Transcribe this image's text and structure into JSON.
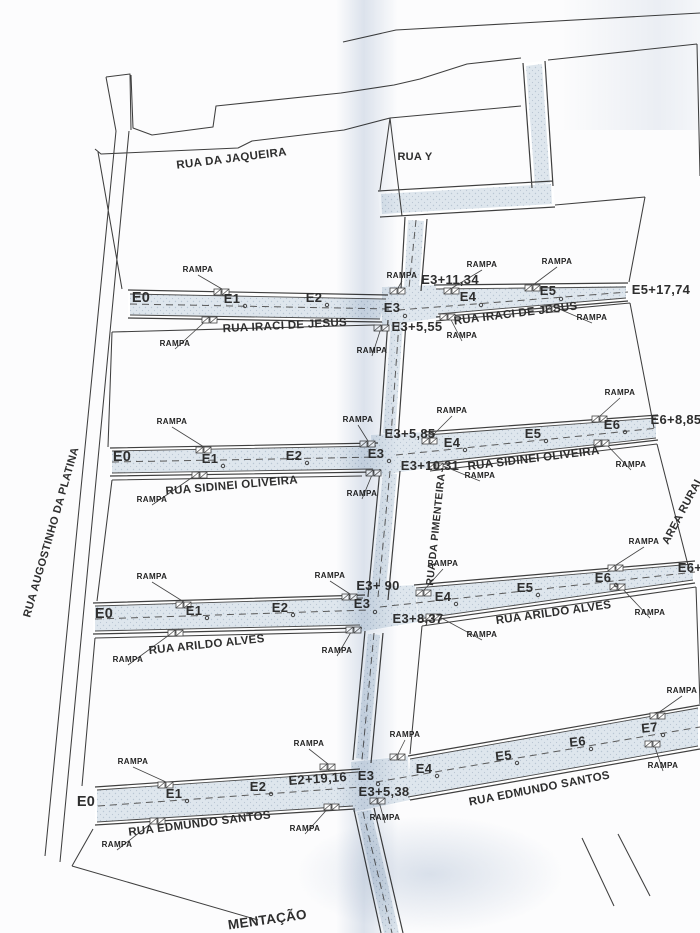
{
  "document": {
    "kind": "scanned street pavement plan"
  },
  "colors": {
    "ink": "#3f3f3f",
    "text": "#2e2e2e",
    "road_fill": "#dee6ed",
    "stipple_dots": "#b9c6d3",
    "paper": "#fcfcfd",
    "fold_shadow": "#c4d0e0"
  },
  "rampa_label": "RAMPA",
  "street_names": [
    "RUA DA JAQUEIRA",
    "RUA Y",
    "RUA IRACI DE JESUS",
    "RUA SIDINEI OLIVEIRA",
    "RUA DA PIMENTEIRA",
    "RUA ARILDO ALVES",
    "RUA EDMUNDO SANTOS",
    "RUA AUGOSTINHO DA PLATINA",
    "AREA RURAL"
  ],
  "labels": [
    {
      "id": "rua-da-jaqueira",
      "text": "RUA DA JAQUEIRA",
      "x": 232,
      "y": 162,
      "rot": -7,
      "size": 11.5
    },
    {
      "id": "rua-y",
      "text": "RUA Y",
      "x": 415,
      "y": 160,
      "rot": 0,
      "size": 11
    },
    {
      "id": "rua-iraci-de-jesus-left",
      "text": "RUA IRACI DE JESUS",
      "x": 285,
      "y": 329,
      "rot": -3,
      "size": 11.5
    },
    {
      "id": "rua-iraci-de-jesus-right",
      "text": "RUA IRACI DE JESUS",
      "x": 516,
      "y": 317,
      "rot": -7,
      "size": 11.5
    },
    {
      "id": "rua-sidinei-oliveira-left",
      "text": "RUA SIDINEI OLIVEIRA",
      "x": 232,
      "y": 489,
      "rot": -5,
      "size": 11.5
    },
    {
      "id": "rua-sidinei-oliveira-right",
      "text": "RUA SIDINEI OLIVEIRA",
      "x": 534,
      "y": 462,
      "rot": -7,
      "size": 11.5
    },
    {
      "id": "rua-arildo-alves-left",
      "text": "RUA ARILDO ALVES",
      "x": 207,
      "y": 648,
      "rot": -6,
      "size": 11.5
    },
    {
      "id": "rua-arildo-alves-right",
      "text": "RUA ARILDO ALVES",
      "x": 554,
      "y": 616,
      "rot": -8,
      "size": 11.5
    },
    {
      "id": "rua-edmundo-santos-left",
      "text": "RUA EDMUNDO SANTOS",
      "x": 200,
      "y": 827,
      "rot": -7,
      "size": 11.5
    },
    {
      "id": "rua-edmundo-santos-right",
      "text": "RUA EDMUNDO SANTOS",
      "x": 540,
      "y": 792,
      "rot": -11,
      "size": 11.5
    },
    {
      "id": "rua-augostinho-da-platina",
      "text": "RUA AUGOSTINHO DA PLATINA",
      "x": 30,
      "y": 618,
      "rot": -74,
      "size": 11,
      "anchor": "start"
    },
    {
      "id": "rua-da-pimenteira",
      "text": "RUA DA PIMENTEIRA",
      "x": 433,
      "y": 586,
      "rot": -84,
      "size": 10.5,
      "anchor": "start"
    },
    {
      "id": "area-rural",
      "text": "AREA RURAL",
      "x": 668,
      "y": 545,
      "rot": -62,
      "size": 11,
      "anchor": "start"
    },
    {
      "id": "bottom-partial-text",
      "text": "MENTAÇÃO",
      "x": 268,
      "y": 924,
      "rot": -8,
      "size": 13.5
    },
    {
      "id": "r1-e0",
      "text": "E0",
      "x": 141,
      "y": 302,
      "rot": 0,
      "size": 14.5
    },
    {
      "id": "r1-e1",
      "text": "E1",
      "x": 232,
      "y": 303,
      "rot": 0,
      "size": 13,
      "dot": [
        13,
        3
      ]
    },
    {
      "id": "r1-e2",
      "text": "E2",
      "x": 314,
      "y": 302,
      "rot": 0,
      "size": 13,
      "dot": [
        13,
        3
      ]
    },
    {
      "id": "r1-e3",
      "text": "E3",
      "x": 392,
      "y": 312,
      "rot": 0,
      "size": 13,
      "dot": [
        13,
        4
      ]
    },
    {
      "id": "r1-e3p11-34",
      "text": "E3+11,34",
      "x": 450,
      "y": 284,
      "rot": 0,
      "size": 13
    },
    {
      "id": "r1-e3p5-55",
      "text": "E3+5,55",
      "x": 417,
      "y": 331,
      "rot": 0,
      "size": 13
    },
    {
      "id": "r1-e4",
      "text": "E4",
      "x": 468,
      "y": 301,
      "rot": 0,
      "size": 13,
      "dot": [
        13,
        4
      ]
    },
    {
      "id": "r1-e5",
      "text": "E5",
      "x": 548,
      "y": 295,
      "rot": 0,
      "size": 13,
      "dot": [
        13,
        4
      ]
    },
    {
      "id": "r1-e5p17-74",
      "text": "E5+17,74",
      "x": 661,
      "y": 294,
      "rot": 0,
      "size": 13
    },
    {
      "id": "r2-e0",
      "text": "E0",
      "x": 122,
      "y": 461,
      "rot": 0,
      "size": 14.5
    },
    {
      "id": "r2-e1",
      "text": "E1",
      "x": 210,
      "y": 463,
      "rot": 0,
      "size": 13,
      "dot": [
        13,
        3
      ]
    },
    {
      "id": "r2-e2",
      "text": "E2",
      "x": 294,
      "y": 460,
      "rot": 0,
      "size": 13,
      "dot": [
        13,
        3
      ]
    },
    {
      "id": "r2-e3",
      "text": "E3",
      "x": 376,
      "y": 458,
      "rot": 0,
      "size": 13,
      "dot": [
        13,
        3
      ]
    },
    {
      "id": "r2-e3p5-85",
      "text": "E3+5,85",
      "x": 410,
      "y": 438,
      "rot": 0,
      "size": 13
    },
    {
      "id": "r2-e3p10-31",
      "text": "E3+10,31",
      "x": 430,
      "y": 470,
      "rot": 0,
      "size": 13
    },
    {
      "id": "r2-e4",
      "text": "E4",
      "x": 452,
      "y": 447,
      "rot": 0,
      "size": 13,
      "dot": [
        13,
        3
      ]
    },
    {
      "id": "r2-e5",
      "text": "E5",
      "x": 533,
      "y": 438,
      "rot": 0,
      "size": 13,
      "dot": [
        13,
        3
      ]
    },
    {
      "id": "r2-e6",
      "text": "E6",
      "x": 612,
      "y": 429,
      "rot": 0,
      "size": 13,
      "dot": [
        13,
        3
      ]
    },
    {
      "id": "r2-e6p8-85",
      "text": "E6+8,85",
      "x": 676,
      "y": 424,
      "rot": 0,
      "size": 13
    },
    {
      "id": "r3-e0",
      "text": "E0",
      "x": 104,
      "y": 618,
      "rot": 0,
      "size": 14.5
    },
    {
      "id": "r3-e1",
      "text": "E1",
      "x": 194,
      "y": 615,
      "rot": 0,
      "size": 13,
      "dot": [
        13,
        3
      ]
    },
    {
      "id": "r3-e2",
      "text": "E2",
      "x": 280,
      "y": 612,
      "rot": 0,
      "size": 13,
      "dot": [
        13,
        3
      ]
    },
    {
      "id": "r3-e3",
      "text": "E3",
      "x": 362,
      "y": 608,
      "rot": 0,
      "size": 13,
      "dot": [
        13,
        4
      ]
    },
    {
      "id": "r3-e3p-90",
      "text": "E3+ 90",
      "x": 378,
      "y": 590,
      "rot": 0,
      "size": 13
    },
    {
      "id": "r3-e3p8-37",
      "text": "E3+8,37",
      "x": 418,
      "y": 623,
      "rot": 0,
      "size": 13
    },
    {
      "id": "r3-e4",
      "text": "E4",
      "x": 443,
      "y": 601,
      "rot": 0,
      "size": 13,
      "dot": [
        13,
        3
      ]
    },
    {
      "id": "r3-e5",
      "text": "E5",
      "x": 525,
      "y": 592,
      "rot": 0,
      "size": 13,
      "dot": [
        13,
        3
      ]
    },
    {
      "id": "r3-e6",
      "text": "E6",
      "x": 603,
      "y": 582,
      "rot": 0,
      "size": 13,
      "dot": [
        13,
        3
      ]
    },
    {
      "id": "r3-e6p",
      "text": "E6+",
      "x": 690,
      "y": 572,
      "rot": 0,
      "size": 13
    },
    {
      "id": "r4-e0",
      "text": "E0",
      "x": 86,
      "y": 806,
      "rot": 0,
      "size": 14.5
    },
    {
      "id": "r4-e1",
      "text": "E1",
      "x": 174,
      "y": 798,
      "rot": 0,
      "size": 13,
      "dot": [
        13,
        3
      ]
    },
    {
      "id": "r4-e2",
      "text": "E2",
      "x": 258,
      "y": 791,
      "rot": 0,
      "size": 13,
      "dot": [
        13,
        3
      ]
    },
    {
      "id": "r4-e2p19-16",
      "text": "E2+19,16",
      "x": 318,
      "y": 783,
      "rot": -4,
      "size": 13
    },
    {
      "id": "r4-e3",
      "text": "E3",
      "x": 366,
      "y": 780,
      "rot": 0,
      "size": 13,
      "dot": [
        12,
        4
      ]
    },
    {
      "id": "r4-e3p5-38",
      "text": "E3+5,38",
      "x": 384,
      "y": 796,
      "rot": 0,
      "size": 13
    },
    {
      "id": "r4-e4",
      "text": "E4",
      "x": 424,
      "y": 773,
      "rot": 0,
      "size": 13,
      "dot": [
        13,
        3
      ]
    },
    {
      "id": "r4-e5",
      "text": "E5",
      "x": 504,
      "y": 760,
      "rot": -6,
      "size": 13,
      "dot": [
        13,
        3
      ]
    },
    {
      "id": "r4-e6",
      "text": "E6",
      "x": 578,
      "y": 746,
      "rot": -6,
      "size": 13,
      "dot": [
        13,
        3
      ]
    },
    {
      "id": "r4-e7",
      "text": "E7",
      "x": 650,
      "y": 732,
      "rot": -6,
      "size": 13,
      "dot": [
        13,
        3
      ]
    }
  ],
  "rampas": [
    {
      "x": 198,
      "y": 272,
      "tx": 222,
      "ty": 292
    },
    {
      "x": 175,
      "y": 346,
      "tx": 210,
      "ty": 320
    },
    {
      "x": 402,
      "y": 278,
      "tx": 398,
      "ty": 291
    },
    {
      "x": 372,
      "y": 353,
      "tx": 382,
      "ty": 328
    },
    {
      "x": 482,
      "y": 267,
      "tx": 452,
      "ty": 291
    },
    {
      "x": 462,
      "y": 338,
      "tx": 448,
      "ty": 317
    },
    {
      "x": 557,
      "y": 264,
      "tx": 533,
      "ty": 288
    },
    {
      "x": 592,
      "y": 320,
      "tx": 552,
      "ty": 309
    },
    {
      "x": 172,
      "y": 424,
      "tx": 204,
      "ty": 450
    },
    {
      "x": 152,
      "y": 502,
      "tx": 200,
      "ty": 475
    },
    {
      "x": 358,
      "y": 422,
      "tx": 368,
      "ty": 444
    },
    {
      "x": 362,
      "y": 496,
      "tx": 374,
      "ty": 473
    },
    {
      "x": 452,
      "y": 413,
      "tx": 430,
      "ty": 441
    },
    {
      "x": 480,
      "y": 478,
      "tx": 436,
      "ty": 466
    },
    {
      "x": 620,
      "y": 395,
      "tx": 600,
      "ty": 419
    },
    {
      "x": 631,
      "y": 467,
      "tx": 602,
      "ty": 443
    },
    {
      "x": 152,
      "y": 579,
      "tx": 184,
      "ty": 605
    },
    {
      "x": 128,
      "y": 662,
      "tx": 176,
      "ty": 633
    },
    {
      "x": 330,
      "y": 578,
      "tx": 350,
      "ty": 597
    },
    {
      "x": 337,
      "y": 653,
      "tx": 354,
      "ty": 630
    },
    {
      "x": 443,
      "y": 566,
      "tx": 424,
      "ty": 593
    },
    {
      "x": 482,
      "y": 637,
      "tx": 434,
      "ty": 617
    },
    {
      "x": 644,
      "y": 544,
      "tx": 616,
      "ty": 568
    },
    {
      "x": 650,
      "y": 615,
      "tx": 618,
      "ty": 587
    },
    {
      "x": 133,
      "y": 764,
      "tx": 166,
      "ty": 785
    },
    {
      "x": 117,
      "y": 847,
      "tx": 158,
      "ty": 821
    },
    {
      "x": 309,
      "y": 746,
      "tx": 328,
      "ty": 767
    },
    {
      "x": 305,
      "y": 831,
      "tx": 332,
      "ty": 807
    },
    {
      "x": 405,
      "y": 737,
      "tx": 398,
      "ty": 757
    },
    {
      "x": 385,
      "y": 820,
      "tx": 378,
      "ty": 801
    },
    {
      "x": 682,
      "y": 693,
      "tx": 658,
      "ty": 716
    },
    {
      "x": 663,
      "y": 768,
      "tx": 653,
      "ty": 744
    }
  ]
}
